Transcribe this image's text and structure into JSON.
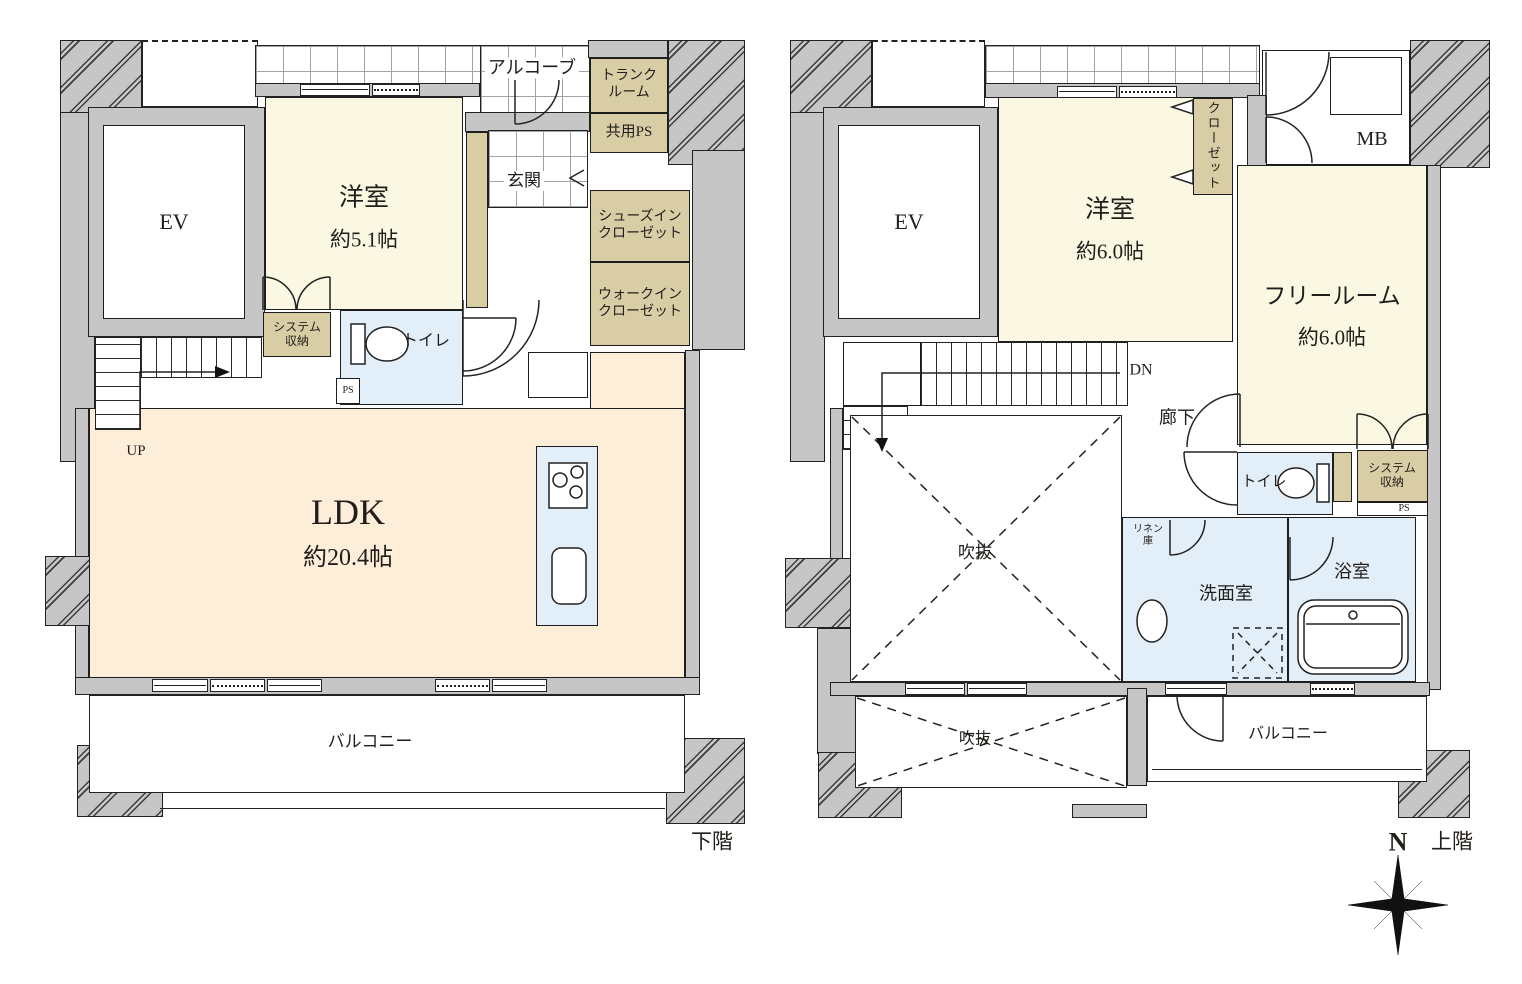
{
  "colors": {
    "wall": "#c6c6c6",
    "cream": "#faf7e3",
    "peach": "#fdeeda",
    "wet": "#e2eff8",
    "beige": "#d9cda6"
  },
  "lower": {
    "title": "下階",
    "ev": "EV",
    "alcove": "アルコーブ",
    "trunk": "トランク\nルーム",
    "shared_ps": "共用PS",
    "entrance": "玄関",
    "shoes_closet": "シューズイン\nクローゼット",
    "walk_in_closet": "ウォークイン\nクローゼット",
    "western_name": "洋室",
    "western_size": "約5.1帖",
    "system_storage": "システム\n収納",
    "toilet": "トイレ",
    "ps": "PS",
    "up": "UP",
    "ldk_name": "LDK",
    "ldk_size": "約20.4帖",
    "balcony": "バルコニー"
  },
  "upper": {
    "title": "上階",
    "ev": "EV",
    "mb": "MB",
    "closet": "クローゼット",
    "western_name": "洋室",
    "western_size": "約6.0帖",
    "free_name": "フリールーム",
    "free_size": "約6.0帖",
    "dn": "DN",
    "hallway": "廊下",
    "void_main": "吹抜",
    "void_lower": "吹抜",
    "toilet": "トイレ",
    "system_storage": "システム\n収納",
    "ps": "PS",
    "linen": "リネン\n庫",
    "washroom": "洗面室",
    "bathroom": "浴室",
    "balcony": "バルコニー"
  },
  "compass": {
    "north": "N"
  }
}
